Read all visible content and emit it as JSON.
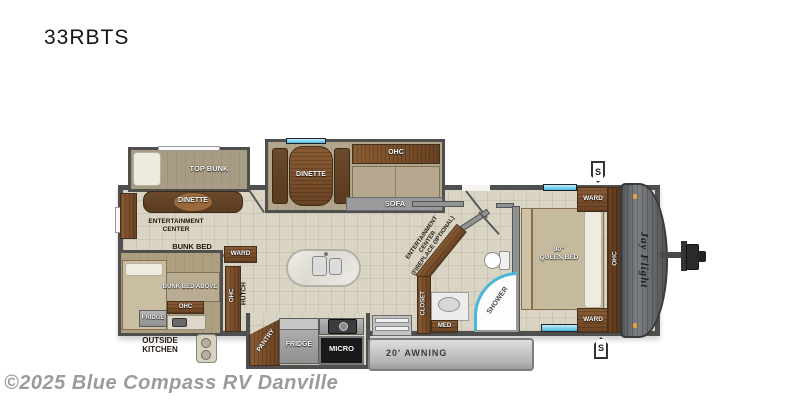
{
  "title": "33RBTS",
  "watermark": "©2025 Blue Compass RV Danville",
  "brand_logo": "Jay Flight",
  "badges": {
    "spare_top": "S",
    "spare_bottom": "S"
  },
  "colors": {
    "wall": "#4f4f4f",
    "floor": "#d9d4c3",
    "wood": "#7a4e29",
    "window_glass": "#49b9e2",
    "awning_bar": "#c9c9c9",
    "appliance_gray": "#9e9e9e",
    "micro_black": "#191919",
    "clearance_light_orange": "#e8a13c"
  },
  "labels": {
    "top_bunk": "TOP BUNK",
    "bunk_dinette": "DINETTE",
    "entertainment_center": [
      "ENTERTAINMENT",
      "CENTER"
    ],
    "bunk_bed": [
      "BUNK BED",
      "W/ STORAGE BELOW"
    ],
    "ward_bunk": "WARD",
    "bunk_bed_above": "BUNK BED ABOVE",
    "ohc_bunk": "OHC",
    "fridge_bunk": "FRIDGE",
    "outside_kitchen": [
      "OUTSIDE",
      "KITCHEN"
    ],
    "ohc_hutch": "OHC",
    "hutch": "HUTCH",
    "main_dinette": "DINETTE",
    "ohc_sofa": "OHC",
    "sofa": "SOFA",
    "ent_center_optional": [
      "ENTERTAINMENT",
      "CENTER",
      "(FIREPLACE OPTIONAL)"
    ],
    "pantry": "PANTRY",
    "fridge_main": "FRIDGE",
    "micro": "MICRO",
    "awning": "20' AWNING",
    "closet": "CLOSET",
    "med": "MED",
    "shower": "SHOWER",
    "queen_bed": [
      "80\"",
      "QUEEN BED"
    ],
    "ward_front_top": "WARD",
    "ward_front_bottom": "WARD",
    "ohc_bed": "OHC"
  }
}
